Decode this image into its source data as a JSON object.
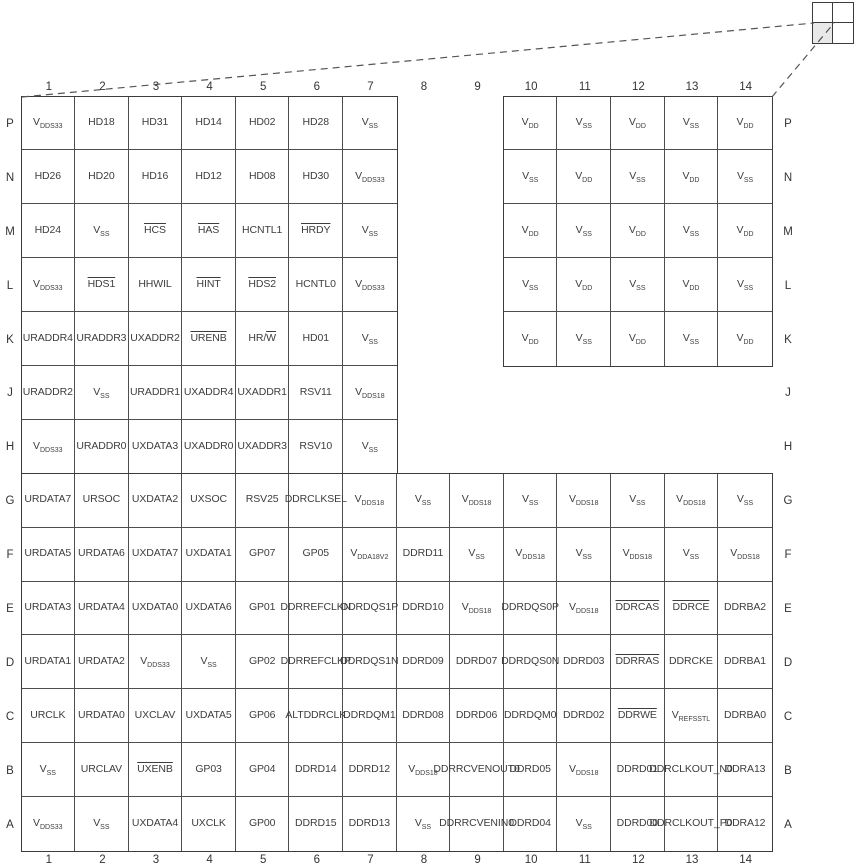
{
  "figure": {
    "kind": "bga-ball-grid-pin-map",
    "colors": {
      "background": "#ffffff",
      "grid_border": "#3c3c3c",
      "inner_line": "#4e4e4e",
      "pin_text": "#3d3d3d",
      "label_text": "#333333",
      "quadrant_shade": "#e9e9e9",
      "dashed_line": "#555555"
    },
    "package_indicator": {
      "grid": "2x2",
      "highlighted_quadrant": "bottom-left"
    },
    "grid": {
      "col_labels": [
        "1",
        "2",
        "3",
        "4",
        "5",
        "6",
        "7",
        "8",
        "9",
        "10",
        "11",
        "12",
        "13",
        "14"
      ],
      "row_labels": [
        "P",
        "N",
        "M",
        "L",
        "K",
        "J",
        "H",
        "G",
        "F",
        "E",
        "D",
        "C",
        "B",
        "A"
      ],
      "pins": [
        [
          "V{DDS33}",
          "HD18",
          "HD31",
          "HD14",
          "HD02",
          "HD28",
          "V{SS}",
          null,
          null,
          "V{DD}",
          "V{SS}",
          "V{DD}",
          "V{SS}",
          "V{DD}"
        ],
        [
          "HD26",
          "HD20",
          "HD16",
          "HD12",
          "HD08",
          "HD30",
          "V{DDS33}",
          null,
          null,
          "V{SS}",
          "V{DD}",
          "V{SS}",
          "V{DD}",
          "V{SS}"
        ],
        [
          "HD24",
          "V{SS}",
          "~HCS~",
          "~HAS~",
          "HCNTL1",
          "~HRDY~",
          "V{SS}",
          null,
          null,
          "V{DD}",
          "V{SS}",
          "V{DD}",
          "V{SS}",
          "V{DD}"
        ],
        [
          "V{DDS33}",
          "~HDS1~",
          "HHWIL",
          "~HINT~",
          "~HDS2~",
          "HCNTL0",
          "V{DDS33}",
          null,
          null,
          "V{SS}",
          "V{DD}",
          "V{SS}",
          "V{DD}",
          "V{SS}"
        ],
        [
          "URADDR4",
          "URADDR3",
          "UXADDR2",
          "~URENB~",
          "HR/~W~",
          "HD01",
          "V{SS}",
          null,
          null,
          "V{DD}",
          "V{SS}",
          "V{DD}",
          "V{SS}",
          "V{DD}"
        ],
        [
          "URADDR2",
          "V{SS}",
          "URADDR1",
          "UXADDR4",
          "UXADDR1",
          "RSV11",
          "V{DDS18}",
          null,
          null,
          null,
          null,
          null,
          null,
          null
        ],
        [
          "V{DDS33}",
          "URADDR0",
          "UXDATA3",
          "UXADDR0",
          "UXADDR3",
          "RSV10",
          "V{SS}",
          null,
          null,
          null,
          null,
          null,
          null,
          null
        ],
        [
          "URDATA7",
          "URSOC",
          "UXDATA2",
          "UXSOC",
          "RSV25",
          "DDRCLKSEL",
          "V{DDS18}",
          "V{SS}",
          "V{DDS18}",
          "V{SS}",
          "V{DDS18}",
          "V{SS}",
          "V{DDS18}",
          "V{SS}"
        ],
        [
          "URDATA5",
          "URDATA6",
          "UXDATA7",
          "UXDATA1",
          "GP07",
          "GP05",
          "V{DDA18V2}",
          "DDRD11",
          "V{SS}",
          "V{DDS18}",
          "V{SS}",
          "V{DDS18}",
          "V{SS}",
          "V{DDS18}"
        ],
        [
          "URDATA3",
          "URDATA4",
          "UXDATA0",
          "UXDATA6",
          "GP01",
          "DDRREF\nCLKN",
          "DDRDQS1P",
          "DDRD10",
          "V{DDS18}",
          "DDRDQS0P",
          "V{DDS18}",
          "~DDRCAS~",
          "~DDRCE~",
          "DDRBA2"
        ],
        [
          "URDATA1",
          "URDATA2",
          "V{DDS33}",
          "V{SS}",
          "GP02",
          "DDRREF\nCLKP",
          "DDRDQS1N",
          "DDRD09",
          "DDRD07",
          "DDRDQS0N",
          "DDRD03",
          "~DDRRAS~",
          "DDRCKE",
          "DDRBA1"
        ],
        [
          "URCLK",
          "URDATA0",
          "UXCLAV",
          "UXDATA5",
          "GP06",
          "ALTDDRCLK",
          "DDRDQM1",
          "DDRD08",
          "DDRD06",
          "DDRDQM0",
          "DDRD02",
          "~DDRWE~",
          "V{REFSSTL}",
          "DDRBA0"
        ],
        [
          "V{SS}",
          "URCLAV",
          "~UXENB~",
          "GP03",
          "GP04",
          "DDRD14",
          "DDRD12",
          "V{DDS18}",
          "DDRRCVEN\nOUT0",
          "DDRD05",
          "V{DDS18}",
          "DDRD01",
          "DDRCLK\nOUT_N0",
          "DDRA13"
        ],
        [
          "V{DDS33}",
          "V{SS}",
          "UXDATA4",
          "UXCLK",
          "GP00",
          "DDRD15",
          "DDRD13",
          "V{SS}",
          "DDRRCVEN\nIN0",
          "DDRD04",
          "V{SS}",
          "DDRD00",
          "DDRCLK\nOUT_P0",
          "DDRA12"
        ]
      ]
    }
  }
}
